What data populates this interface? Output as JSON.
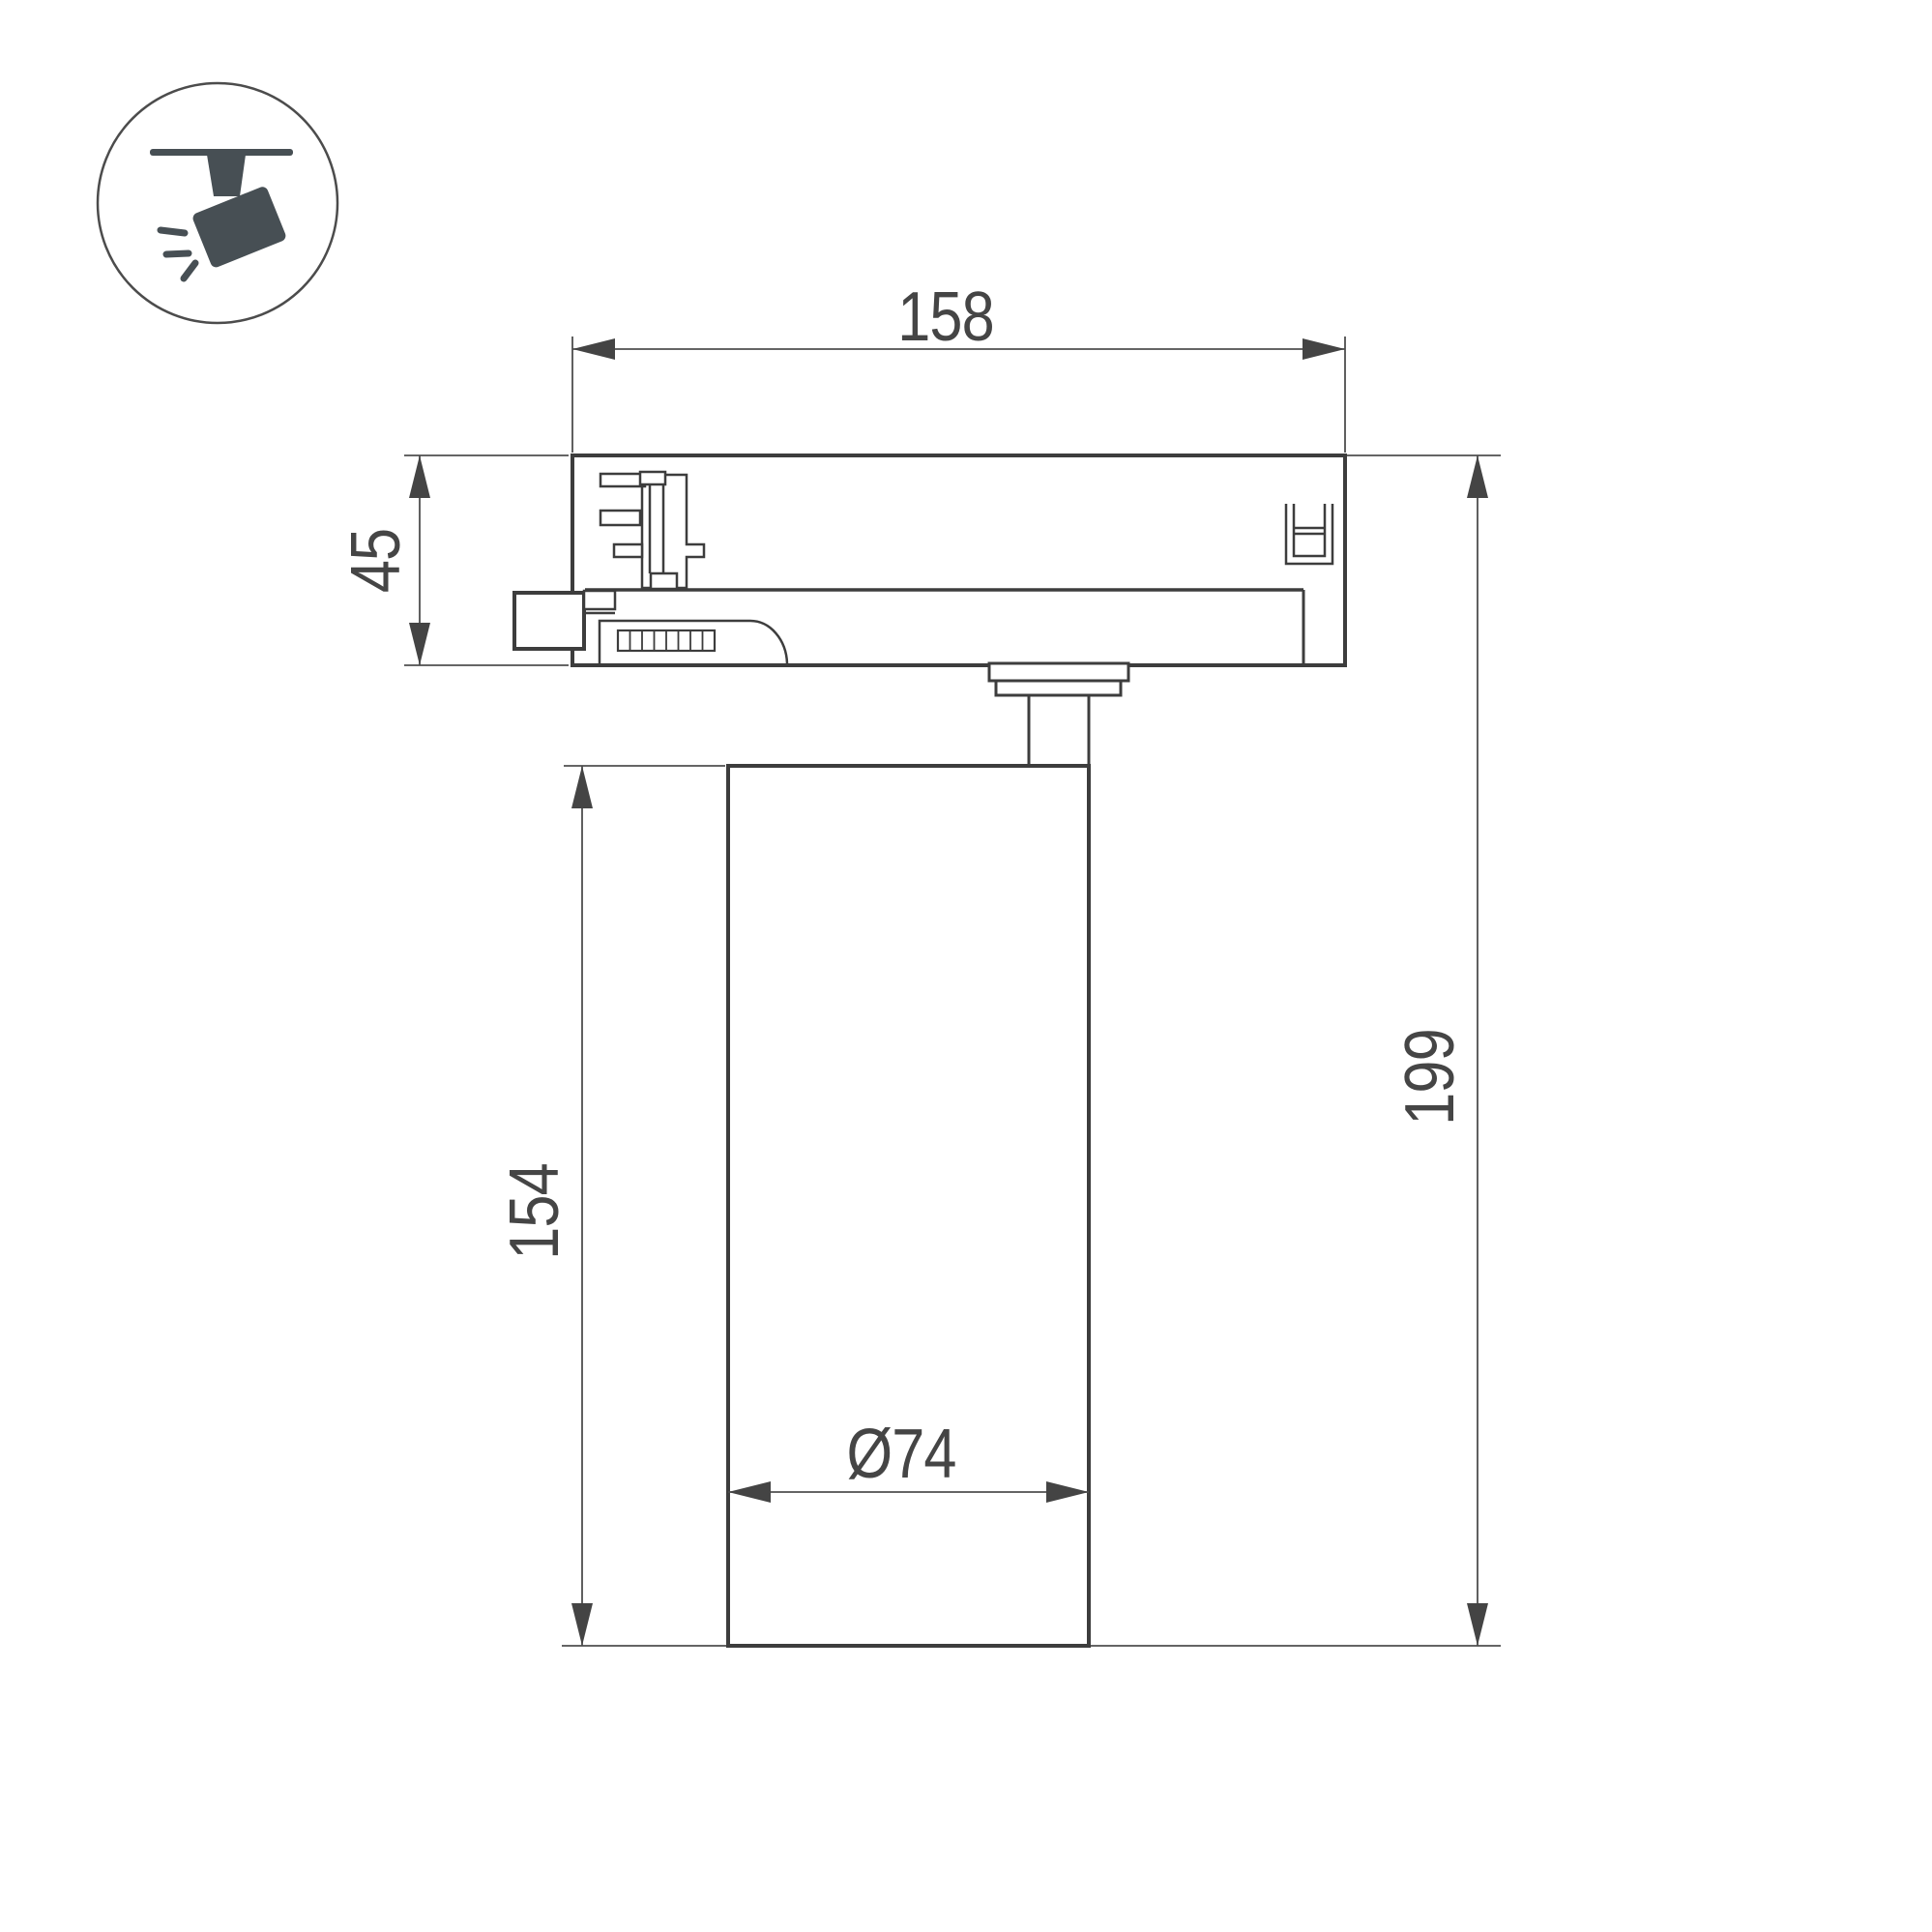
{
  "page": {
    "background": "#ffffff",
    "title": "track-spotlight-dimension-drawing"
  },
  "icon": {
    "name": "track-spotlight-icon",
    "color": "#474f54",
    "outline_color": "#4c4c4c"
  },
  "drawing": {
    "line_color": "#3d3d3d",
    "dimension_line_color": "#4f4f4f",
    "text_color": "#454545",
    "dimensions": {
      "adapter_width": "158",
      "adapter_height": "45",
      "body_length": "154",
      "overall_height": "199",
      "diameter": "Ø74"
    }
  }
}
